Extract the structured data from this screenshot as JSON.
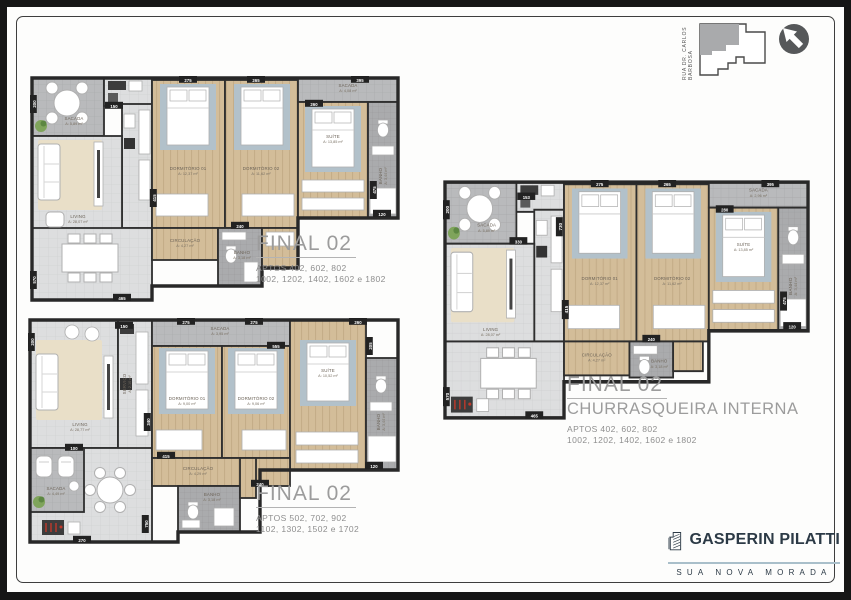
{
  "frame": {
    "street_label": "RUA DR. CARLOS BARBOSA"
  },
  "plans": [
    {
      "title": "FINAL 02",
      "subtitle": "",
      "apts1": "APTOS 402, 602, 802",
      "apts2": "1002, 1202, 1402, 1602 e 1802",
      "rooms": {
        "sacada": {
          "label": "SACADA",
          "area": "A: 5,89 m²"
        },
        "servico": {
          "label": "SERVIÇO",
          "area": "A: 2,10 m²"
        },
        "living": {
          "label": "LIVING",
          "area": "A: 28,07 m²"
        },
        "dorm1": {
          "label": "DORMITÓRIO 01",
          "area": "A: 12,37 m²"
        },
        "dorm2": {
          "label": "DORMITÓRIO 02",
          "area": "A: 11,62 m²"
        },
        "suite": {
          "label": "SUÍTE",
          "area": "A: 13,85 m²"
        },
        "sacada2": {
          "label": "SACADA",
          "area": "A: 4,08 m²"
        },
        "circulacao": {
          "label": "CIRCULAÇÃO",
          "area": "A: 4,27 m²"
        },
        "banho": {
          "label": "BANHO",
          "area": "A: 3,18 m²"
        },
        "banho_suite": {
          "label": "BANHO",
          "area": "A: 3,44 m²"
        }
      },
      "dims": [
        "200",
        "275",
        "265",
        "395",
        "150",
        "260",
        "415",
        "240",
        "465",
        "120",
        "475",
        "570"
      ]
    },
    {
      "title": "FINAL 02",
      "subtitle": "",
      "apts1": "APTOS 502, 702, 902",
      "apts2": "1102, 1302, 1502 e 1702",
      "rooms": {
        "sacada": {
          "label": "SACADA",
          "area": "A: 4,49 m²"
        },
        "servico": {
          "label": "SERVIÇO",
          "area": "A: 2,10 m²"
        },
        "living": {
          "label": "LIVING",
          "area": "A: 28,77 m²"
        },
        "dorm1": {
          "label": "DORMITÓRIO 01",
          "area": "A: 9,00 m²"
        },
        "dorm2": {
          "label": "DORMITÓRIO 02",
          "area": "A: 9,06 m²"
        },
        "suite": {
          "label": "SUÍTE",
          "area": "A: 10,52 m²"
        },
        "sacada2": {
          "label": "SACADA",
          "area": "A: 3,95 m²"
        },
        "circulacao": {
          "label": "CIRCULAÇÃO",
          "area": "A: 4,29 m²"
        },
        "banho": {
          "label": "BANHO",
          "area": "A: 3,18 m²"
        },
        "banho_suite": {
          "label": "BANHO",
          "area": "A: 3,44 m²"
        }
      },
      "dims": [
        "200",
        "275",
        "275",
        "260",
        "150",
        "555",
        "100",
        "340",
        "270",
        "750",
        "240",
        "415",
        "205",
        "120"
      ]
    },
    {
      "title": "FINAL 02",
      "subtitle": "CHURRASQUEIRA INTERNA",
      "apts1": "APTOS 402, 602, 802",
      "apts2": "1002, 1202, 1402, 1602 e 1802",
      "rooms": {
        "sacada": {
          "label": "SACADA",
          "area": "A: 5,89 m²"
        },
        "servico": {
          "label": "SERVIÇO",
          "area": "A: 2,10 m²"
        },
        "living": {
          "label": "LIVING",
          "area": "A: 28,07 m²"
        },
        "dorm1": {
          "label": "DORMITÓRIO 01",
          "area": "A: 12,37 m²"
        },
        "dorm2": {
          "label": "DORMITÓRIO 02",
          "area": "A: 11,62 m²"
        },
        "suite": {
          "label": "SUÍTE",
          "area": "A: 13,85 m²"
        },
        "sacada2": {
          "label": "SACADA",
          "area": "A: 2,96 m²"
        },
        "circulacao": {
          "label": "CIRCULAÇÃO",
          "area": "A: 4,27 m²"
        },
        "banho": {
          "label": "BANHO",
          "area": "A: 3,18 m²"
        },
        "banho_suite": {
          "label": "BANHO",
          "area": "A: 3,44 m²"
        }
      },
      "dims": [
        "200",
        "275",
        "265",
        "395",
        "153",
        "730",
        "280",
        "330",
        "415",
        "240",
        "465",
        "120",
        "475",
        "570"
      ]
    }
  ],
  "logo": {
    "name": "GASPERIN PILATTI",
    "tagline": "SUA NOVA MORADA"
  }
}
